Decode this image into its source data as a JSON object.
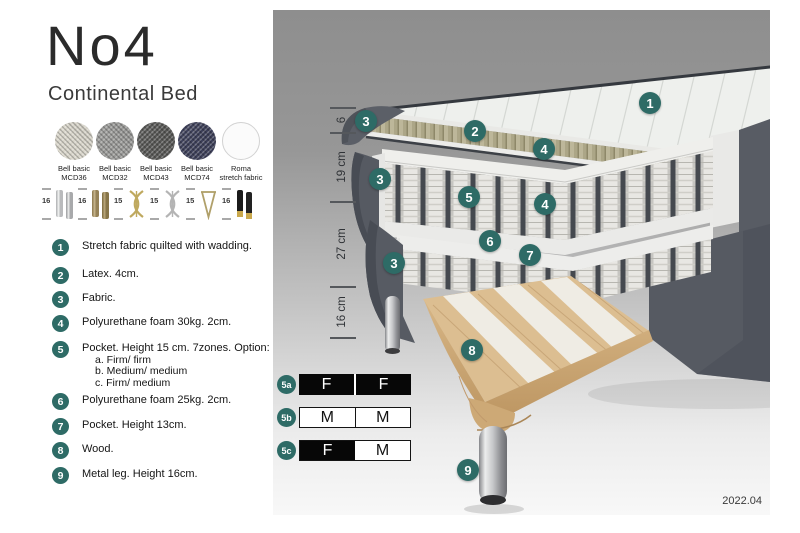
{
  "header": {
    "title": "No4",
    "subtitle": "Continental Bed"
  },
  "fabrics": [
    {
      "line1": "Bell basic",
      "line2": "MCD36",
      "swatch": "light-weave"
    },
    {
      "line1": "Bell basic",
      "line2": "MCD32",
      "swatch": "gray-weave"
    },
    {
      "line1": "Bell basic",
      "line2": "MCD43",
      "swatch": "dark-gray-weave"
    },
    {
      "line1": "Bell basic",
      "line2": "MCD74",
      "swatch": "navy-weave"
    },
    {
      "line1": "Roma",
      "line2": "stretch fabric",
      "swatch": "plain-white"
    }
  ],
  "legs": [
    {
      "height": "16",
      "style": "chrome-cylinder-pair"
    },
    {
      "height": "16",
      "style": "wood-cylinder-pair"
    },
    {
      "height": "15",
      "style": "gold-twist"
    },
    {
      "height": "15",
      "style": "silver-twist"
    },
    {
      "height": "15",
      "style": "gold-hairpin"
    },
    {
      "height": "16",
      "style": "black-gold-cylinder-pair"
    }
  ],
  "features": [
    {
      "num": "1",
      "text": "Stretch fabric quilted with wadding."
    },
    {
      "num": "2",
      "text": "Latex. 4cm."
    },
    {
      "num": "3",
      "text": "Fabric."
    },
    {
      "num": "4",
      "text": "Polyurethane foam 30kg. 2cm."
    },
    {
      "num": "5",
      "text": "Pocket. Height 15 cm. 7zones. Option:",
      "options": [
        "a. Firm/ firm",
        "b. Medium/ medium",
        "c. Firm/ medium"
      ]
    },
    {
      "num": "6",
      "text": "Polyurethane foam 25kg. 2cm."
    },
    {
      "num": "7",
      "text": "Pocket. Height 13cm."
    },
    {
      "num": "8",
      "text": "Wood."
    },
    {
      "num": "9",
      "text": "Metal leg. Height 16cm."
    }
  ],
  "diagram": {
    "dimensions": [
      "6",
      "19 cm",
      "27 cm",
      "16 cm"
    ],
    "callouts": [
      {
        "n": "1"
      },
      {
        "n": "3"
      },
      {
        "n": "2"
      },
      {
        "n": "4"
      },
      {
        "n": "3"
      },
      {
        "n": "5"
      },
      {
        "n": "4"
      },
      {
        "n": "6"
      },
      {
        "n": "7"
      },
      {
        "n": "3"
      },
      {
        "n": "8"
      },
      {
        "n": "9"
      }
    ],
    "firmness": [
      {
        "id": "5a",
        "cells": [
          {
            "label": "F",
            "fill": "black"
          },
          {
            "label": "F",
            "fill": "black"
          }
        ]
      },
      {
        "id": "5b",
        "cells": [
          {
            "label": "M",
            "fill": "white"
          },
          {
            "label": "M",
            "fill": "white"
          }
        ]
      },
      {
        "id": "5c",
        "cells": [
          {
            "label": "F",
            "fill": "black"
          },
          {
            "label": "M",
            "fill": "white"
          }
        ]
      }
    ],
    "version": "2022.04"
  },
  "colors": {
    "accent_teal": "#2e6b66",
    "fabric_dark": "#575b63",
    "latex": "#aca687",
    "wood": "#dcbe91"
  }
}
